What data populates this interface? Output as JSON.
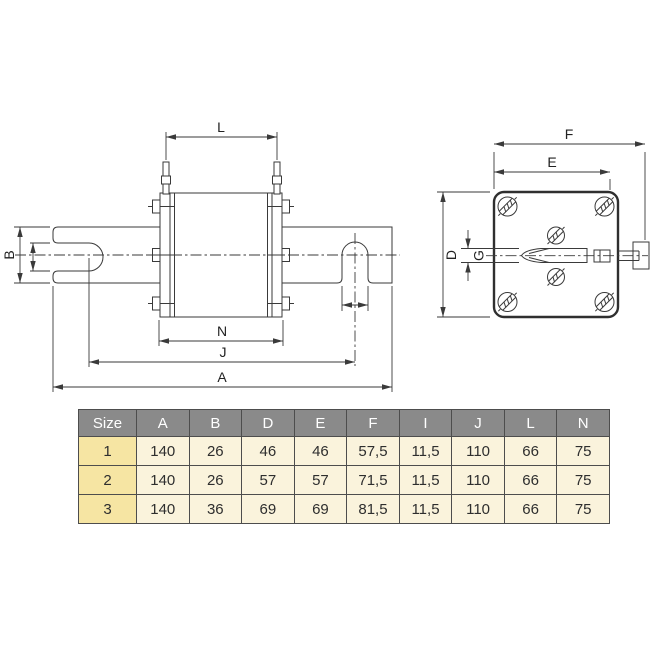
{
  "side_view": {
    "labels": {
      "L": "L",
      "B": "B",
      "N": "N",
      "J": "J",
      "A": "A"
    }
  },
  "front_view": {
    "labels": {
      "F": "F",
      "E": "E",
      "D": "D",
      "G": "G"
    }
  },
  "table": {
    "columns": [
      "Size",
      "A",
      "B",
      "D",
      "E",
      "F",
      "I",
      "J",
      "L",
      "N"
    ],
    "rows": [
      [
        "1",
        "140",
        "26",
        "46",
        "46",
        "57,5",
        "11,5",
        "110",
        "66",
        "75"
      ],
      [
        "2",
        "140",
        "26",
        "57",
        "57",
        "71,5",
        "11,5",
        "110",
        "66",
        "75"
      ],
      [
        "3",
        "140",
        "36",
        "69",
        "69",
        "81,5",
        "11,5",
        "110",
        "66",
        "75"
      ]
    ],
    "colors": {
      "header_bg": "#8a8a8a",
      "header_text": "#ffffff",
      "size_col_bg": "#f6e5a3",
      "cell_bg": "#faf3dc",
      "border": "#4d4d4d",
      "text": "#2e2e2e"
    }
  }
}
